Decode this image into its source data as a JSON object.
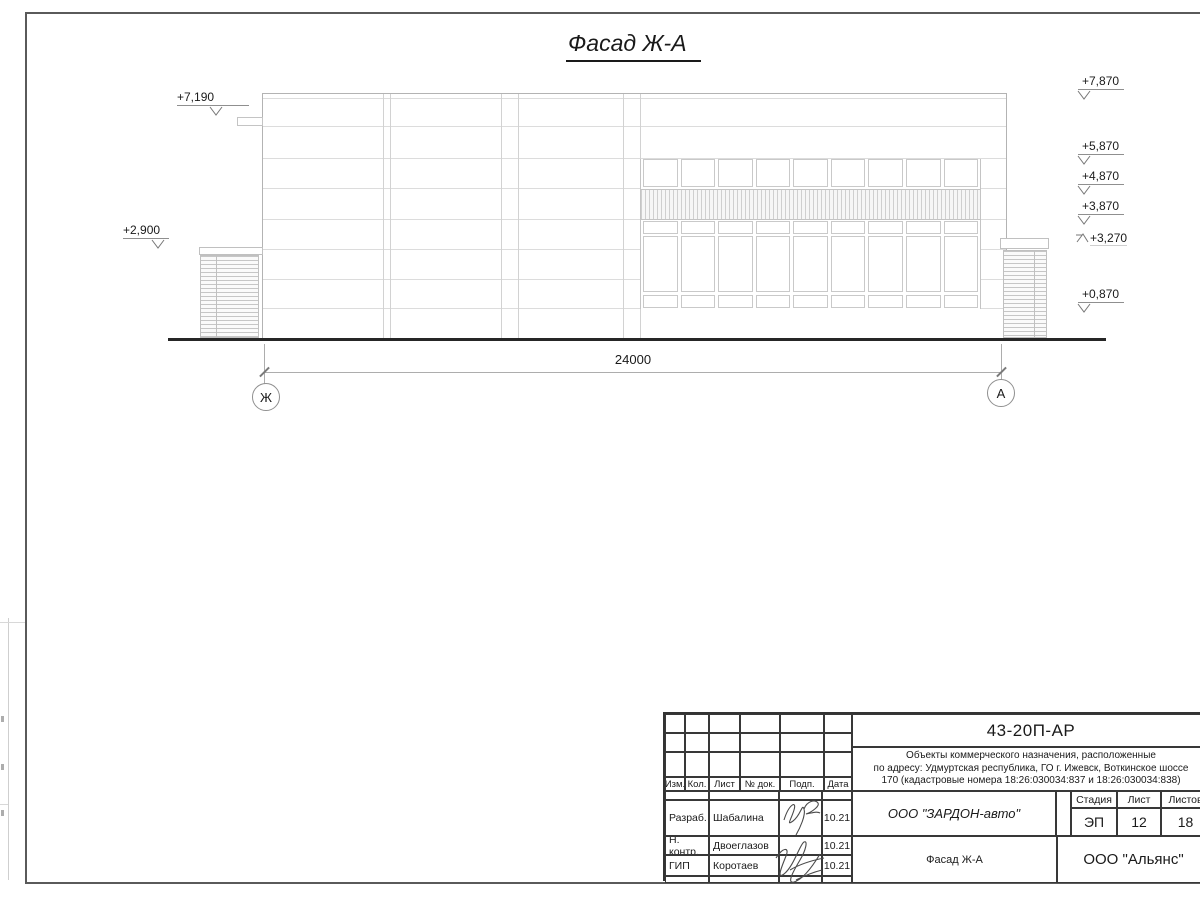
{
  "sheet": {
    "title": "Фасад Ж-А "
  },
  "elevation_marks": {
    "left": [
      "+7,190",
      "+2,900"
    ],
    "right": [
      "+7,870",
      "+5,870",
      "+4,870",
      "+3,870",
      "+3,270",
      "+0,870"
    ]
  },
  "dimension": {
    "value": "24000"
  },
  "axes": {
    "left": "Ж",
    "right": "А"
  },
  "titleblock": {
    "doc_number": "43-20П-АР",
    "project_lines": [
      "Объекты коммерческого назначения, расположенные",
      "по адресу: Удмуртская республика, ГО г. Ижевск, Воткинское шоссе",
      "170 (кадастровые номера 18:26:030034:837 и 18:26:030034:838)"
    ],
    "columns": [
      "Изм.",
      "Кол.",
      "Лист",
      "№ док.",
      "Подп.",
      "Дата"
    ],
    "rows": [
      {
        "role": "Разраб.",
        "name": "Шабалина",
        "date": "10.21"
      },
      {
        "role": "Н. контр.",
        "name": "Двоеглазов",
        "date": "10.21"
      },
      {
        "role": "ГИП",
        "name": "Коротаев",
        "date": "10.21"
      }
    ],
    "client": "ООО \"ЗАРДОН-авто\"",
    "stage_header": [
      "Стадия",
      "Лист",
      "Листов"
    ],
    "stage": "ЭП",
    "sheet_no": "12",
    "sheets_total": "18",
    "drawing_name": "Фасад Ж-А",
    "organization": "ООО \"Альянс\""
  }
}
